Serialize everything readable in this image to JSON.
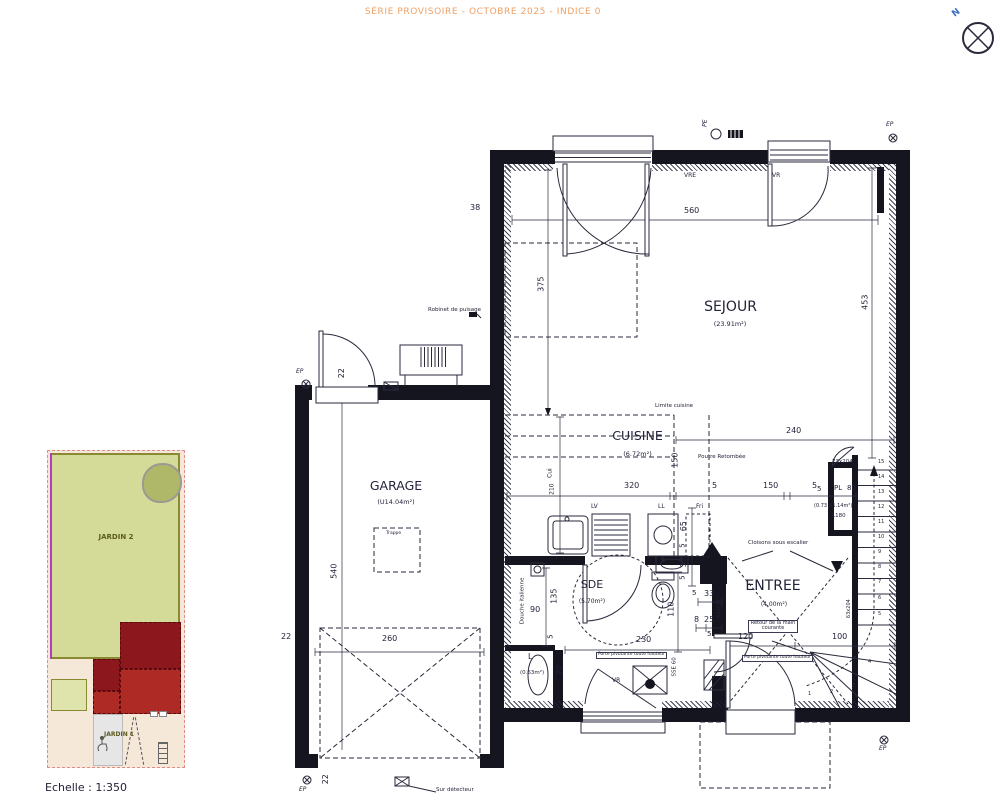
{
  "title": "SÉRIE PROVISOIRE - OCTOBRE 2025 - INDICE 0",
  "north": {
    "label": "N"
  },
  "scale_label": "Echelle : 1:350",
  "colors": {
    "title_orange": "#ef9f63",
    "north_blue": "#3f6fc1",
    "garden_green": "#d4da97",
    "building_dark_red": "#8c181d",
    "building_red": "#ae2a24",
    "ink": "#23233a"
  },
  "site": {
    "jardin2": "JARDIN 2",
    "jardin1": "JARDIN 1"
  },
  "rooms": {
    "sejour": {
      "name": "SEJOUR",
      "area": "(23.91m²)"
    },
    "cuisine": {
      "name": "CUISINE",
      "area": "(6.72m²)"
    },
    "garage": {
      "name": "GARAGE",
      "area": "(U14.04m²)"
    },
    "sde": {
      "name": "SDE",
      "area": "(5.70m²)"
    },
    "entree": {
      "name": "ENTREE",
      "area": "(4.00m²)"
    },
    "lingerie": {
      "name": "L",
      "area": "(0.63m²)"
    }
  },
  "dims": {
    "n560": "560",
    "n453": "453",
    "n375": "375",
    "n38": "38",
    "n240": "240",
    "n320": "320",
    "n150": "150",
    "n5": "5",
    "n210": "210",
    "n90": "90",
    "n135": "135",
    "n230": "230",
    "n110": "110",
    "n65": "65",
    "n30": "30",
    "n33": "33",
    "n8": "8",
    "n25": "25",
    "n120": "120",
    "n100": "100",
    "n70": "70",
    "n540": "540",
    "n260": "260",
    "n22": "22",
    "n80": "80"
  },
  "ann": {
    "limite": "Limite cuisine",
    "poutre": "Poutre Retombée",
    "lv": "LV",
    "ll": "LL",
    "fri": "Fri",
    "cui": "Cui",
    "douche": "Douche italienne",
    "cloisons": "Cloisons sous escalier",
    "retour": "Retour de la main courante",
    "porte": "Porte pivotante toute hauteur",
    "robinet": "Robinet de puisage",
    "detecteur": "Sur détecteur",
    "trappe": "Trappe",
    "vre": "VRE",
    "vr": "VR",
    "pe": "PE",
    "ep": "EP",
    "pl": "PL",
    "d73": "73x204",
    "d63": "63x204",
    "plinfo": "(0.73 U1.14m²)",
    "l180": "L180",
    "sse": "SSE 60"
  },
  "stairs": {
    "numbers": [
      "1",
      "2",
      "3",
      "4",
      "5",
      "6",
      "7",
      "8",
      "9",
      "10",
      "11",
      "12",
      "13",
      "14",
      "15"
    ]
  }
}
